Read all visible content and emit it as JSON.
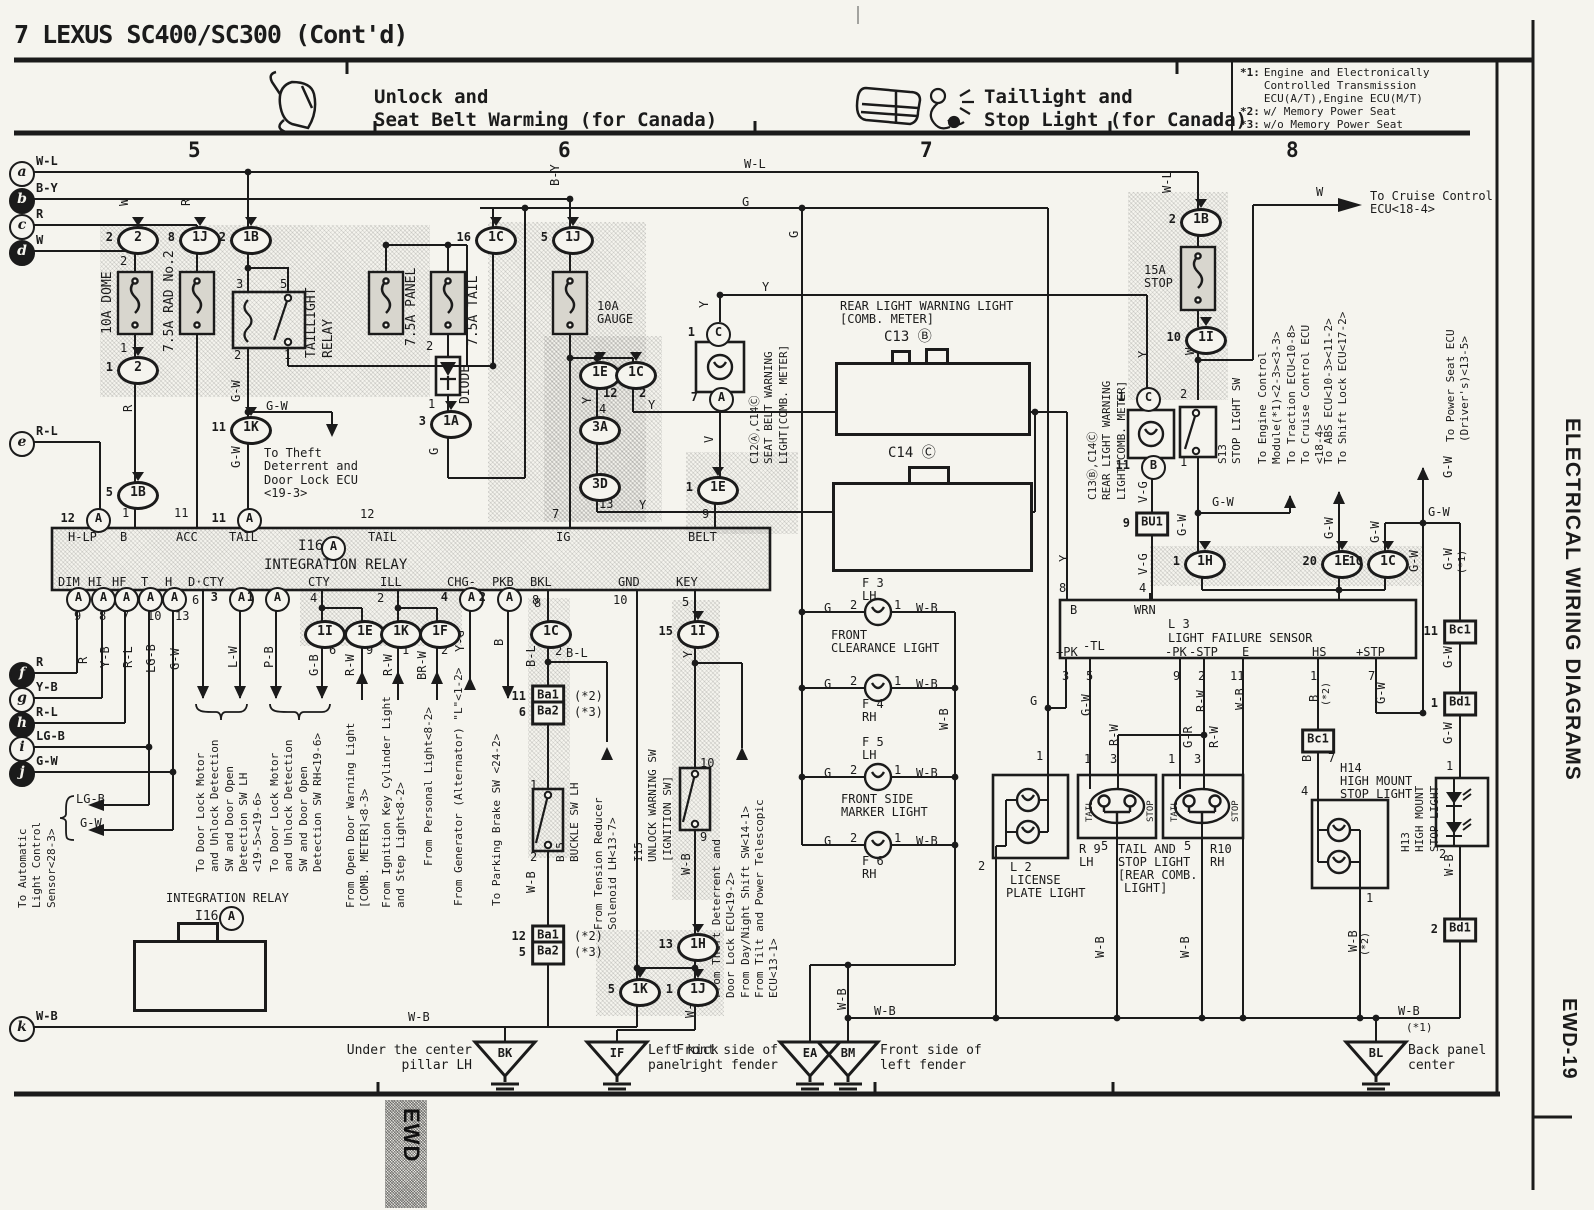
{
  "header": {
    "title": "7 LEXUS SC400/SC300 (Cont'd)",
    "left_section": {
      "line1": "Unlock and",
      "line2": "Seat Belt Warming (for Canada)"
    },
    "right_section": {
      "line1": "Taillight and",
      "line2": "Stop Light (for Canada)"
    },
    "notes": [
      {
        "key": "*1:",
        "text": "Engine and Electronically\nControlled Transmission\nECU(A/T),Engine ECU(M/T)"
      },
      {
        "key": "*2:",
        "text": "w/ Memory Power Seat"
      },
      {
        "key": "*3:",
        "text": "w/o Memory Power Seat"
      }
    ],
    "columns": [
      "5",
      "6",
      "7",
      "8"
    ]
  },
  "sidebar": {
    "title": "ELECTRICAL WIRING DIAGRAMS",
    "page_code": "EWD-19",
    "tab": "EWD"
  },
  "rows": [
    {
      "id": "a",
      "letter": "a",
      "label": "W-L",
      "filled": false
    },
    {
      "id": "b",
      "letter": "b",
      "label": "B-Y",
      "filled": true
    },
    {
      "id": "c",
      "letter": "c",
      "label": "R",
      "filled": false
    },
    {
      "id": "d",
      "letter": "d",
      "label": "W",
      "filled": true
    },
    {
      "id": "e",
      "letter": "e",
      "label": "R-L",
      "filled": false
    },
    {
      "id": "f",
      "letter": "f",
      "label": "R",
      "filled": true
    },
    {
      "id": "g",
      "letter": "g",
      "label": "Y-B",
      "filled": false
    },
    {
      "id": "h",
      "letter": "h",
      "label": "R-L",
      "filled": true
    },
    {
      "id": "i",
      "letter": "i",
      "label": "LG-B",
      "filled": false
    },
    {
      "id": "j",
      "letter": "j",
      "label": "G-W",
      "filled": true
    },
    {
      "id": "k",
      "letter": "k",
      "label": "W-B",
      "filled": false
    }
  ],
  "grounds": [
    {
      "id": "BK",
      "code": "BK",
      "location": "Under the center\npillar LH"
    },
    {
      "id": "IF",
      "code": "IF",
      "location": "Left kick\npanel"
    },
    {
      "id": "EA",
      "code": "EA",
      "location": "Front side of\nright fender"
    },
    {
      "id": "BM",
      "code": "BM",
      "location": "Front side of\nleft fender"
    },
    {
      "id": "BL",
      "code": "BL",
      "location": "Back panel\ncenter"
    }
  ],
  "connectors": [
    {
      "id": "o1",
      "type": "oval",
      "code": "2",
      "pin": "2"
    },
    {
      "id": "o2",
      "type": "oval",
      "code": "2",
      "pin": "1"
    },
    {
      "id": "o3",
      "type": "oval",
      "code": "1J",
      "pin": "8"
    },
    {
      "id": "o4",
      "type": "oval",
      "code": "1B",
      "pin": "2"
    },
    {
      "id": "o5",
      "type": "oval",
      "code": "1K",
      "pin": "11"
    },
    {
      "id": "o6",
      "type": "oval",
      "code": "1C",
      "pin": "16"
    },
    {
      "id": "o7",
      "type": "oval",
      "code": "1J",
      "pin": "5"
    },
    {
      "id": "o8",
      "type": "oval",
      "code": "1A",
      "pin": "3"
    },
    {
      "id": "o9",
      "type": "oval",
      "code": "1B",
      "pin": "5"
    },
    {
      "id": "o10",
      "type": "oval",
      "code": "1E",
      "pin": "12"
    },
    {
      "id": "o11",
      "type": "oval",
      "code": "1C",
      "pin": "2"
    },
    {
      "id": "o12",
      "type": "oval",
      "code": "3A",
      "pin": ""
    },
    {
      "id": "o13",
      "type": "oval",
      "code": "3D",
      "pin": ""
    },
    {
      "id": "o14",
      "type": "oval",
      "code": "1E",
      "pin": "1"
    },
    {
      "id": "o15",
      "type": "oval",
      "code": "1B",
      "pin": "2"
    },
    {
      "id": "o16",
      "type": "oval",
      "code": "1I",
      "pin": "10"
    },
    {
      "id": "o17",
      "type": "oval",
      "code": "1H",
      "pin": "1"
    },
    {
      "id": "o18",
      "type": "oval",
      "code": "1E",
      "pin": "20"
    },
    {
      "id": "o19",
      "type": "oval",
      "code": "1C",
      "pin": "10"
    },
    {
      "id": "o20",
      "type": "oval",
      "code": "1C",
      "pin": ""
    },
    {
      "id": "o21",
      "type": "oval",
      "code": "1I",
      "pin": "15"
    },
    {
      "id": "o22",
      "type": "oval",
      "code": "1I",
      "pin": ""
    },
    {
      "id": "o23",
      "type": "oval",
      "code": "1E",
      "pin": ""
    },
    {
      "id": "o24",
      "type": "oval",
      "code": "1K",
      "pin": ""
    },
    {
      "id": "o25",
      "type": "oval",
      "code": "1F",
      "pin": ""
    },
    {
      "id": "o26",
      "type": "oval",
      "code": "1H",
      "pin": "13"
    },
    {
      "id": "o27",
      "type": "oval",
      "code": "1K",
      "pin": "5"
    },
    {
      "id": "o28",
      "type": "oval",
      "code": "1J",
      "pin": "1"
    },
    {
      "id": "c1",
      "type": "circle",
      "code": "A",
      "pin": "12"
    },
    {
      "id": "c2",
      "type": "circle",
      "code": "A",
      "pin": "11"
    },
    {
      "id": "c3",
      "type": "circle",
      "code": "A",
      "pin": ""
    },
    {
      "id": "c4",
      "type": "circle",
      "code": "A",
      "pin": "3"
    },
    {
      "id": "c5",
      "type": "circle",
      "code": "A",
      "pin": "1"
    },
    {
      "id": "c6",
      "type": "circle",
      "code": "A",
      "pin": ""
    },
    {
      "id": "c7",
      "type": "circle",
      "code": "A",
      "pin": ""
    },
    {
      "id": "c8",
      "type": "circle",
      "code": "A",
      "pin": ""
    },
    {
      "id": "c9",
      "type": "circle",
      "code": "A",
      "pin": ""
    },
    {
      "id": "c10",
      "type": "circle",
      "code": "A",
      "pin": ""
    },
    {
      "id": "c11",
      "type": "circle",
      "code": "A",
      "pin": "4"
    },
    {
      "id": "c12",
      "type": "circle",
      "code": "A",
      "pin": "2"
    },
    {
      "id": "c13c",
      "type": "circle",
      "code": "C",
      "pin": "1"
    },
    {
      "id": "c14c",
      "type": "circle",
      "code": "A",
      "pin": "7"
    },
    {
      "id": "c15",
      "type": "circle",
      "code": "C",
      "pin": "1"
    },
    {
      "id": "c16",
      "type": "circle",
      "code": "B",
      "pin": "11"
    },
    {
      "id": "c18",
      "type": "circle",
      "code": "A",
      "pin": ""
    },
    {
      "id": "r1",
      "type": "rect",
      "code": "BU1",
      "pin": "9"
    },
    {
      "id": "r2",
      "type": "rect",
      "code": "Ba1",
      "pin": "11",
      "note": "(*2)"
    },
    {
      "id": "r3",
      "type": "rect",
      "code": "Ba2",
      "pin": "6",
      "note": "(*3)"
    },
    {
      "id": "r4",
      "type": "rect",
      "code": "Ba1",
      "pin": "12",
      "note": "(*2)"
    },
    {
      "id": "r5",
      "type": "rect",
      "code": "Ba2",
      "pin": "5",
      "note": "(*3)"
    },
    {
      "id": "r6",
      "type": "rect",
      "code": "Bc1",
      "pin": "11"
    },
    {
      "id": "r7",
      "type": "rect",
      "code": "Bd1",
      "pin": "1"
    },
    {
      "id": "r8",
      "type": "rect",
      "code": "Bc1",
      "pin": ""
    },
    {
      "id": "r9",
      "type": "rect",
      "code": "Bd1",
      "pin": "2"
    }
  ],
  "connector_grids": {
    "c13": {
      "rows": [
        [
          [
            "1",
            "2"
          ],
          [
            "3",
            "4"
          ],
          [
            "5",
            "6"
          ],
          [
            "7",
            "8"
          ]
        ],
        [
          [
            "9",
            "10"
          ],
          [
            "11",
            "12",
            "13",
            "14",
            "15",
            "16"
          ],
          [
            "17",
            "18"
          ]
        ]
      ]
    },
    "c14": {
      "rows": [
        [
          [
            "1",
            "2",
            "3",
            "4",
            "5"
          ],
          [
            "6",
            "7",
            "8",
            "9",
            "10"
          ]
        ],
        [
          [
            "11",
            "12",
            "13",
            "14",
            "15",
            "16",
            "17",
            "18",
            "19",
            "20",
            "21",
            "22",
            "23"
          ]
        ]
      ]
    },
    "i16": {
      "rows": [
        [
          [
            "1",
            "2",
            "3",
            "4",
            "5",
            "6",
            "7",
            "8",
            "9",
            "10",
            "11",
            "12",
            "13"
          ]
        ]
      ]
    }
  },
  "labels": {
    "wl_mid": "W-L",
    "g_mid": "G",
    "y_belt": "Y",
    "w_d": "W",
    "r_c": "R",
    "by_b": "B-Y",
    "wl_stop": "W-L",
    "w_cruise": "W",
    "cruise1": "To Cruise Control\nECU<18-4>",
    "p2_dome": "2",
    "p1_dome": "1",
    "r_dome": "R",
    "p1_b": "1",
    "p11_acc": "11",
    "p3_tlr": "3",
    "p5_tlr": "5",
    "p2_tlr": "2",
    "p1_tlr": "1",
    "gw1": "G-W",
    "gw2": "G-W",
    "gw3": "G-W",
    "theft1": "To Theft\nDeterrent and\nDoor Lock ECU\n<19-3>",
    "p2_tail": "2",
    "p1_diode": "1",
    "g_1a": "G",
    "g_bus": "G",
    "p12_tail": "12",
    "gauge1": "10A",
    "gauge2": "GAUGE",
    "p7_ig": "7",
    "ig": "IG",
    "belt": "BELT",
    "p9_belt": "9",
    "hlp": "H-LP",
    "b_pin": "B",
    "acc": "ACC",
    "tail1": "TAIL",
    "tail2": "TAIL",
    "i16": "I16",
    "intrelay": "INTEGRATION RELAY",
    "dim": "DIM",
    "hi": "HI",
    "hf": "HF",
    "t_pin": "T",
    "h_pin": "H",
    "dcty": "D·CTY",
    "cty": "CTY",
    "ill": "ILL",
    "chg": "CHG-",
    "pkb": "PKB",
    "bkl": "BKL",
    "gnd": "GND",
    "key": "KEY",
    "n9": "9",
    "n8": "8",
    "n7": "7",
    "n10": "10",
    "n13": "13",
    "n6": "6",
    "n4c": "4",
    "n2i": "2",
    "n8b": "8",
    "n10g": "10",
    "n5k": "5",
    "wr": "R",
    "wyb": "Y-B",
    "wrl": "R-L",
    "wlgb": "LG-B",
    "wgw": "G-W",
    "wlw": "L-W",
    "wpb": "P-B",
    "wgb": "G-B",
    "wrw1": "R-W",
    "wrw2": "R-W",
    "wbrw": "BR-W",
    "wyg": "Y-G",
    "wb_pkb": "B",
    "n6i": "6",
    "n9e": "9",
    "n1k": "1",
    "n2f": "2",
    "lgb_s": "LG-B",
    "gw_s": "G-W",
    "y3a": "Y",
    "n4a": "4",
    "n13d": "13",
    "y1c": "Y",
    "y3d": "Y",
    "ysb": "Y",
    "v_sb": "V",
    "bl1": "B-L",
    "bl2": "B-L",
    "n1bk": "1",
    "n2bk": "2",
    "wb_bk": "W-B",
    "n10u": "10",
    "n9u": "9",
    "yu": "Y",
    "wbu": "W-B",
    "wbif": "W-B",
    "wbk": "W-B",
    "n2bkl": "2",
    "n8r": "8",
    "g1": "G",
    "p2f1": "2",
    "p1f1": "1",
    "wb1": "W-B",
    "f3": "F 3",
    "f3s": "LH",
    "g2": "G",
    "p2f2": "2",
    "p1f2": "1",
    "wb2": "W-B",
    "f4": "F 4",
    "f4s": "RH",
    "g3": "G",
    "p2f3": "2",
    "p1f3": "1",
    "wb3": "W-B",
    "f5": "F 5",
    "f5s": "LH",
    "g4": "G",
    "p2f4": "2",
    "p1f4": "1",
    "wb4": "W-B",
    "f6": "F 6",
    "f6s": "RH",
    "fc1": "FRONT",
    "fc2": "CLEARANCE LIGHT",
    "fm1": "FRONT SIDE",
    "fm2": "MARKER LIGHT",
    "wbbus": "W-B",
    "wbbm": "W-B",
    "wbh": "W-B",
    "rear1": "REAR LIGHT WARNING LIGHT",
    "rear2": "[COMB. METER]",
    "c13t": "C13 Ⓑ",
    "c14t": "C14 Ⓒ",
    "yb8": "Y",
    "ysb2": "Y",
    "vg1": "V-G",
    "vg2": "V-G",
    "n8s": "8",
    "n4s": "4",
    "sens_b": "B",
    "sens_wrn": "WRN",
    "l3a": "L 3",
    "l3b": "LIGHT FAILURE SENSOR",
    "spk": "+PK",
    "stl": "-TL",
    "spk2": "-PK",
    "sstp": "-STP",
    "se": "E",
    "shs": "HS",
    "sstp2": "+STP",
    "sn3": "3",
    "sn5": "5",
    "sn9": "9",
    "sn2": "2",
    "sn11": "11",
    "sn1": "1",
    "sn7": "7",
    "sgw1": "G-W",
    "srw1": "R-W",
    "swb1": "W-B",
    "sb1": "B",
    "sb2": "(*2)",
    "sgw2": "G-W",
    "srw9": "R-W",
    "sgr": "G-R",
    "srw10": "R-W",
    "rn1a": "1",
    "rn3a": "3",
    "rn1b": "1",
    "rn3b": "3",
    "r9a": "R 9",
    "r9b": "LH",
    "r9n5": "5",
    "tas1": "TAIL AND",
    "tas2": "STOP LIGHT",
    "tas3": "[REAR COMB.",
    "tas4": "LIGHT]",
    "r10n5": "5",
    "r10a": "R10",
    "r10b": "RH",
    "tail_r9": "TAIL",
    "stop_r9": "STOP",
    "tail_r10": "TAIL",
    "stop_r10": "STOP",
    "wbr9": "W-B",
    "wbr10": "W-B",
    "l2n1": "1",
    "l2n2": "2",
    "l2a": "L 2",
    "l2b": "LICENSE",
    "l2c": "PLATE LIGHT",
    "bc1n7": "7",
    "bc1b": "B",
    "h14n4": "4",
    "h14a": "H14",
    "h14b": "HIGH MOUNT",
    "h14c": "STOP LIGHT",
    "h14n1": "1",
    "wb14": "W-B",
    "wb14n": "(*2)",
    "wbbl": "W-B",
    "wbbln": "(*1)",
    "gwps": "G-W",
    "gwj": "G-W",
    "gw1c": "G-W",
    "gwm1": "G-W",
    "gwm1n": "(*1)",
    "gwm2": "G-W",
    "gwm3": "G-W",
    "h13n1": "1",
    "h13n2": "2",
    "wbh13": "W-B",
    "gws13": "G-W",
    "gws13b": "G-W",
    "gw20": "G-W",
    "gw10": "G-W",
    "s13n2": "2",
    "s13n1": "1",
    "w_stop": "W",
    "stf1": "15A",
    "stf2": "STOP",
    "g_lic": "G",
    "igr1": "INTEGRATION RELAY",
    "igr2": "I16"
  },
  "vtexts": {
    "v1": [
      "10A DOME"
    ],
    "v2": [
      "7.5A RAD No.2"
    ],
    "v3": [
      "7.5A PANEL"
    ],
    "v4": [
      "7.5A TAIL"
    ],
    "v5": [
      "DIODE"
    ],
    "v6": [
      "TAILLIGHT",
      "RELAY"
    ],
    "v7": [
      "To Door Lock Motor",
      "and Unlock Detection",
      "SW and Door Open",
      "Detection SW LH",
      "<19-5><19-6>"
    ],
    "v8": [
      "To Door Lock Motor",
      "and Unlock Detection",
      "SW and Door Open",
      "Detection SW RH<19-6>"
    ],
    "v9": [
      "From Open Door Warning Light",
      "[COMB. METER]<8-3>"
    ],
    "v10": [
      "From Ignition Key Cylinder Light",
      "and Step Light<8-2>"
    ],
    "v11": [
      "From Personal Light<8-2>"
    ],
    "v12": [
      "From Generator (Alternator) \"L\"<1-2>"
    ],
    "v13": [
      "To Parking Brake SW <24-2>"
    ],
    "v14": [
      "To Automatic",
      "Light Control",
      "Sensor<28-3>"
    ],
    "v15": [
      "B 5",
      "BUCKLE SW LH"
    ],
    "v16": [
      "From Tension Reducer",
      "Solenoid LH<13-7>"
    ],
    "v17": [
      "I15",
      "UNLOCK WARNING SW",
      "[IGNITION SW]"
    ],
    "v18": [
      "From Theft Deterrent and",
      "Door Lock ECU<19-2>",
      "From Day/Night Shift SW<14-1>",
      "From Tilt and Power Telescopic",
      "ECU<13-1>"
    ],
    "v19": [
      "C12Ⓐ,C14Ⓒ",
      "SEAT BELT WARNING",
      "LIGHT[COMB. METER]"
    ],
    "v20": [
      "C13Ⓑ,C14Ⓒ",
      "REAR LIGHT WARNING",
      "LIGHT[COMB. METER]"
    ],
    "v21": [
      "S13",
      "STOP LIGHT SW"
    ],
    "v22": [
      "To Engine Control",
      "Module(*1)<2-3><3-3>",
      "To Traction ECU<10-8>",
      "To Cruise Control ECU",
      "<18-4>"
    ],
    "v23": [
      "To ABS ECU<10-3><11-2>",
      "To Shift Lock ECU<17-2>"
    ],
    "v24": [
      "To Power Seat ECU",
      "(Driver's)<13-5>"
    ],
    "v25": [
      "H13",
      "HIGH MOUNT",
      "STOP LIGHT"
    ]
  }
}
